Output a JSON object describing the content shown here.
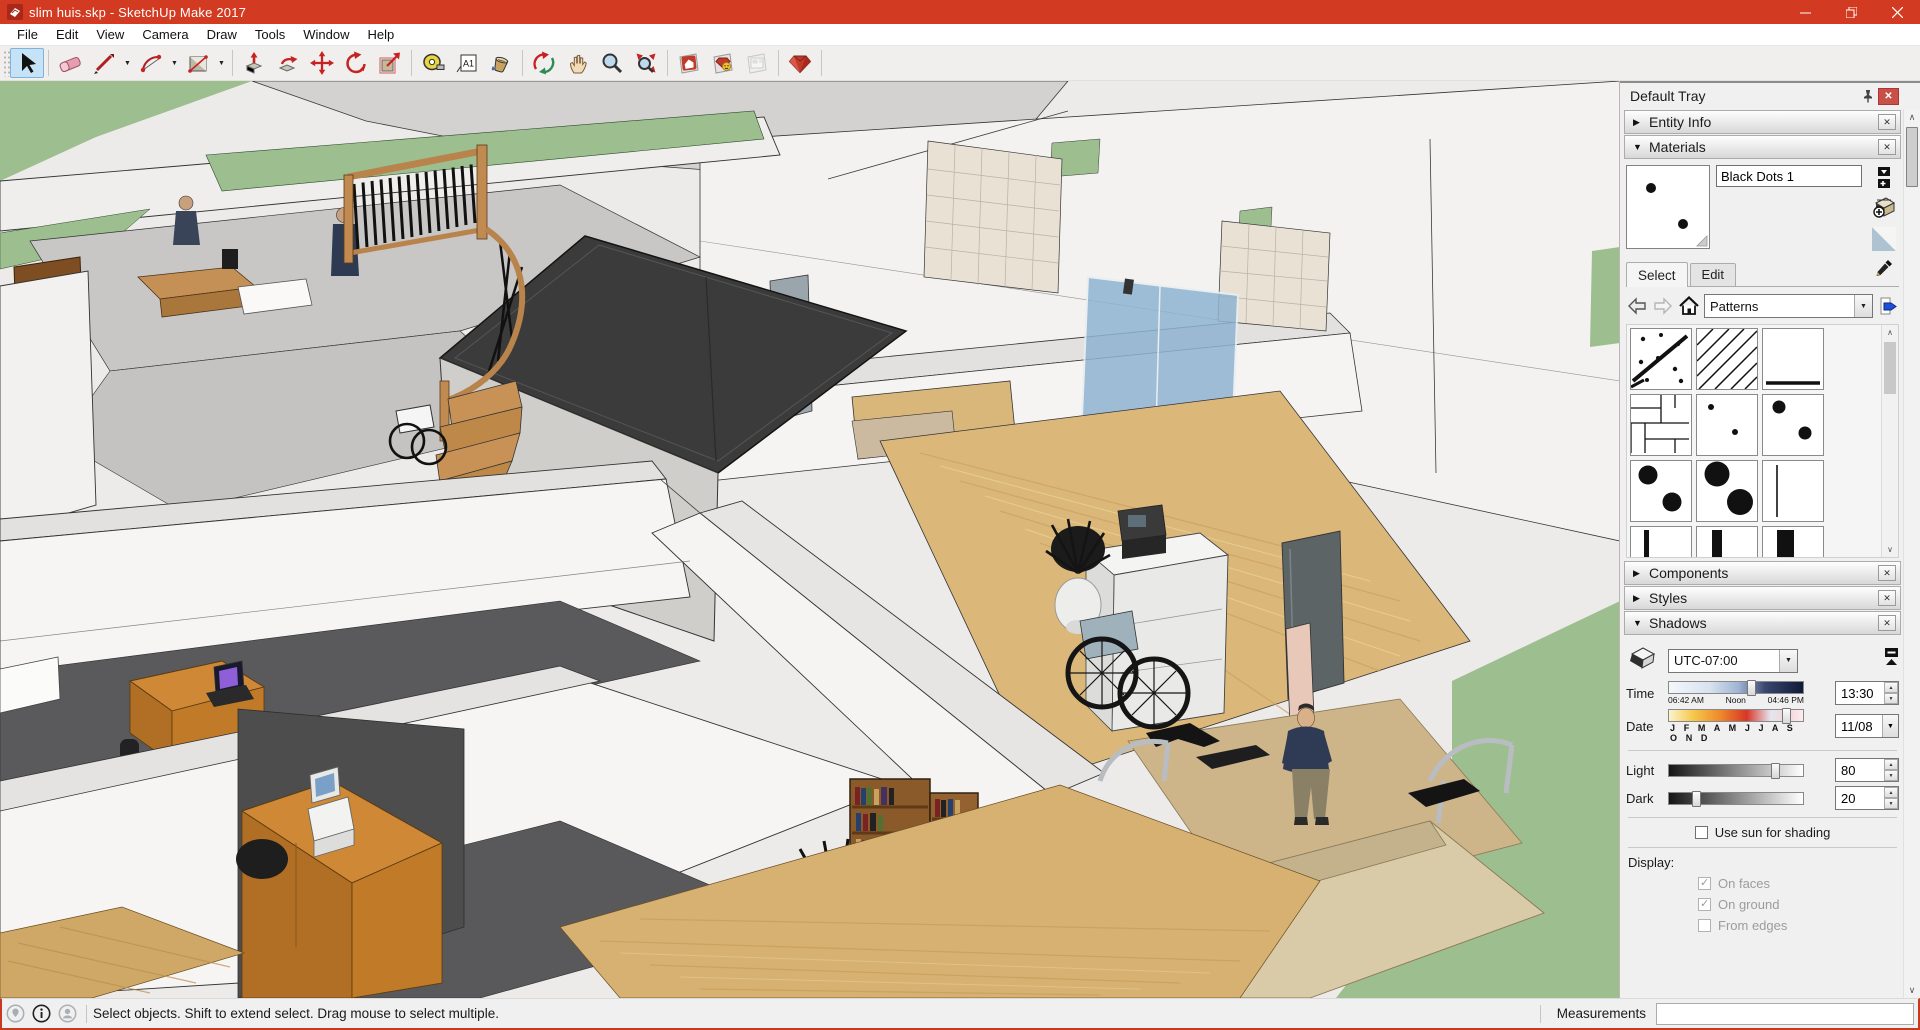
{
  "window": {
    "title": "slim huis.skp - SketchUp Make 2017",
    "controls": [
      "minimize",
      "restore",
      "close"
    ]
  },
  "menu": {
    "items": [
      "File",
      "Edit",
      "View",
      "Camera",
      "Draw",
      "Tools",
      "Window",
      "Help"
    ]
  },
  "toolbar": {
    "active_tool": "select",
    "tools": [
      "select",
      "eraser",
      "line",
      "arc",
      "rectangle",
      "push-pull",
      "follow-me",
      "move",
      "rotate",
      "scale",
      "tape-measure",
      "text",
      "paint-bucket",
      "orbit",
      "pan",
      "zoom",
      "zoom-extents",
      "get-models",
      "share-model",
      "send-to-layout",
      "extension-warehouse"
    ]
  },
  "tray": {
    "title": "Default Tray",
    "sections": [
      {
        "label": "Entity Info",
        "expanded": false
      },
      {
        "label": "Materials",
        "expanded": true
      },
      {
        "label": "Components",
        "expanded": false
      },
      {
        "label": "Styles",
        "expanded": false
      },
      {
        "label": "Shadows",
        "expanded": true
      }
    ],
    "materials": {
      "current_name": "Black Dots 1",
      "tabs": [
        "Select",
        "Edit"
      ],
      "active_tab": "Select",
      "collection": "Patterns",
      "swatches": [
        "dots-with-line",
        "diagonal-hatch",
        "underline",
        "panel-lines",
        "small-dots",
        "medium-dots",
        "large-dots",
        "xlarge-dots",
        "thin-vline",
        "thin-vbar",
        "medium-vbar",
        "thick-vbar"
      ],
      "icons": [
        "back",
        "forward",
        "home",
        "details",
        "secondary-pane",
        "create-material",
        "default-material",
        "sample-paint"
      ]
    },
    "shadows": {
      "timezone": "UTC-07:00",
      "time_label": "Time",
      "time_value": "13:30",
      "time_ticks": [
        "06:42 AM",
        "Noon",
        "04:46 PM"
      ],
      "date_label": "Date",
      "date_value": "11/08",
      "date_ticks": "J F M A M J J A S O N D",
      "light_label": "Light",
      "light_value": "80",
      "dark_label": "Dark",
      "dark_value": "20",
      "use_sun_label": "Use sun for shading",
      "use_sun_checked": false,
      "display_label": "Display:",
      "display_options": [
        {
          "label": "On faces",
          "checked": true
        },
        {
          "label": "On ground",
          "checked": true
        },
        {
          "label": "From edges",
          "checked": false
        }
      ]
    }
  },
  "statusbar": {
    "icons": [
      "geolocation",
      "info",
      "account"
    ],
    "message": "Select objects. Shift to extend select. Drag mouse to select multiple.",
    "measurements_label": "Measurements",
    "measurements_value": ""
  },
  "colors": {
    "titlebar": "#D23A21",
    "select_active_bg": "#C6E2F7",
    "grass": "#9DBE8F",
    "wood_floor": "#DBB87A",
    "carpet": "#59595B",
    "desk_wood": "#CE8836",
    "roof_dark": "#3B3B3B"
  }
}
